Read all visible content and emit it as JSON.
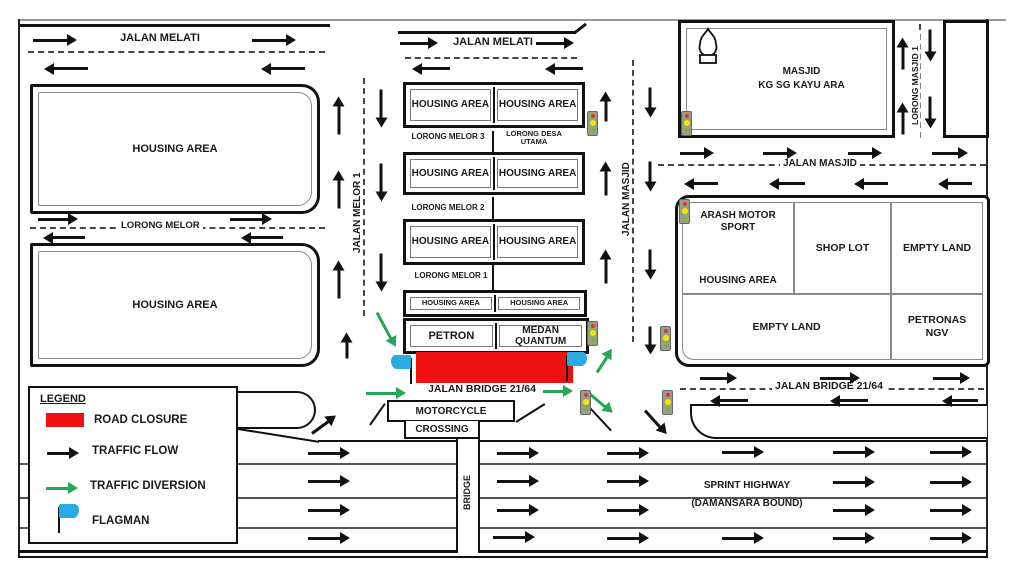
{
  "legend": {
    "title": "LEGEND",
    "road_closure": "ROAD CLOSURE",
    "traffic_flow": "TRAFFIC FLOW",
    "traffic_diversion": "TRAFFIC DIVERSION",
    "flagman": "FLAGMAN"
  },
  "roads": {
    "jalan_melati_left": "JALAN MELATI",
    "jalan_melati_mid": "JALAN MELATI",
    "lorong_melor": "LORONG MELOR",
    "jalan_melor_1": "JALAN MELOR 1",
    "lorong_melor_3": "LORONG MELOR 3",
    "lorong_desa_utama": "LORONG DESA UTAMA",
    "lorong_melor_2": "LORONG MELOR 2",
    "lorong_melor_1": "LORONG MELOR 1",
    "jalan_masjid_vertical": "JALAN MASJID",
    "jalan_masjid_horizontal": "JALAN MASJID",
    "lorong_masjid_1": "LORONG MASJID 1",
    "jalan_bridge_west": "JALAN BRIDGE 21/64",
    "jalan_bridge_east": "JALAN BRIDGE 21/64",
    "motorcycle_line1": "MOTORCYCLE",
    "motorcycle_line2": "CROSSING",
    "bridge": "BRIDGE",
    "sprint_highway_line1": "SPRINT HIGHWAY",
    "sprint_highway_line2": "(DAMANSARA BOUND)"
  },
  "areas": {
    "housing_nw": "HOUSING AREA",
    "housing_sw": "HOUSING AREA",
    "housing_cell": "HOUSING AREA",
    "masjid_line1": "MASJID",
    "masjid_line2": "KG SG KAYU ARA",
    "arash_line1": "ARASH MOTOR SPORT",
    "arash_line2": "HOUSING AREA",
    "shop_lot": "SHOP LOT",
    "empty_land_top": "EMPTY LAND",
    "empty_land_bottom": "EMPTY LAND",
    "petronas_line1": "PETRONAS",
    "petronas_line2": "NGV",
    "petron": "PETRON",
    "medan_quantum_line1": "MEDAN",
    "medan_quantum_line2": "QUANTUM"
  },
  "colors": {
    "road_closure": "#ee1111",
    "traffic_flow": "#111111",
    "traffic_diversion": "#27a657",
    "flagman": "#29abe2",
    "traffic_light_body": "#98a07e"
  }
}
